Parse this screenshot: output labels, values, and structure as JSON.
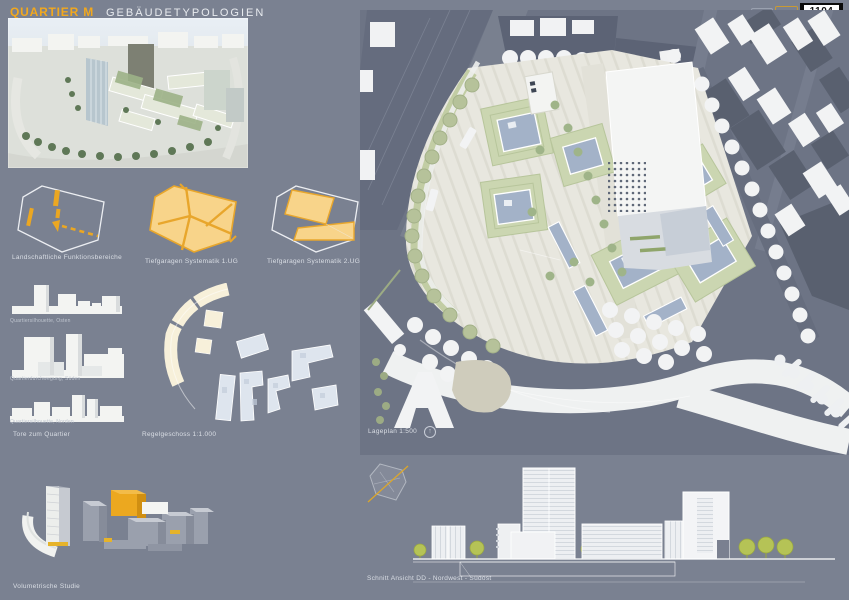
{
  "header": {
    "title": "QUARTIER M",
    "subtitle": "GEBÄUDETYPOLOGIEN",
    "plate_number": "1104"
  },
  "diagrams": {
    "items": [
      {
        "label": "Landschaftliche Funktionsbereiche"
      },
      {
        "label": "Tiefgaragen Systematik 1.UG"
      },
      {
        "label": "Tiefgaragen Systematik 2.UG"
      }
    ]
  },
  "massing": {
    "items": [
      {
        "caption": "Quartiersilhouette, Osten"
      },
      {
        "caption": "Quartierdurchwegung, Süden"
      },
      {
        "caption": "Quartiersilhouette, Norden"
      }
    ],
    "label": "Tore zum Quartier"
  },
  "floorplate": {
    "label": "Regelgeschoss 1:1.000"
  },
  "siteplan": {
    "label": "Lageplan 1:500",
    "north_icon": "north-arrow-icon",
    "scale": "1:500"
  },
  "volumetric": {
    "label": "Volumetrische Studie"
  },
  "section": {
    "label": "Schnitt Ansicht DD - Nordwest - Südost"
  },
  "colors": {
    "accent_orange": "#f2a81d",
    "garage_fill": "#f8d48a",
    "garage_line": "#e8a62c",
    "board_bg": "#7a8191",
    "courtyard_green": "#cbd6b1",
    "roof_blue": "#a3b2c8",
    "plan_street": "#6d7485",
    "context_dark": "#5c6375"
  }
}
